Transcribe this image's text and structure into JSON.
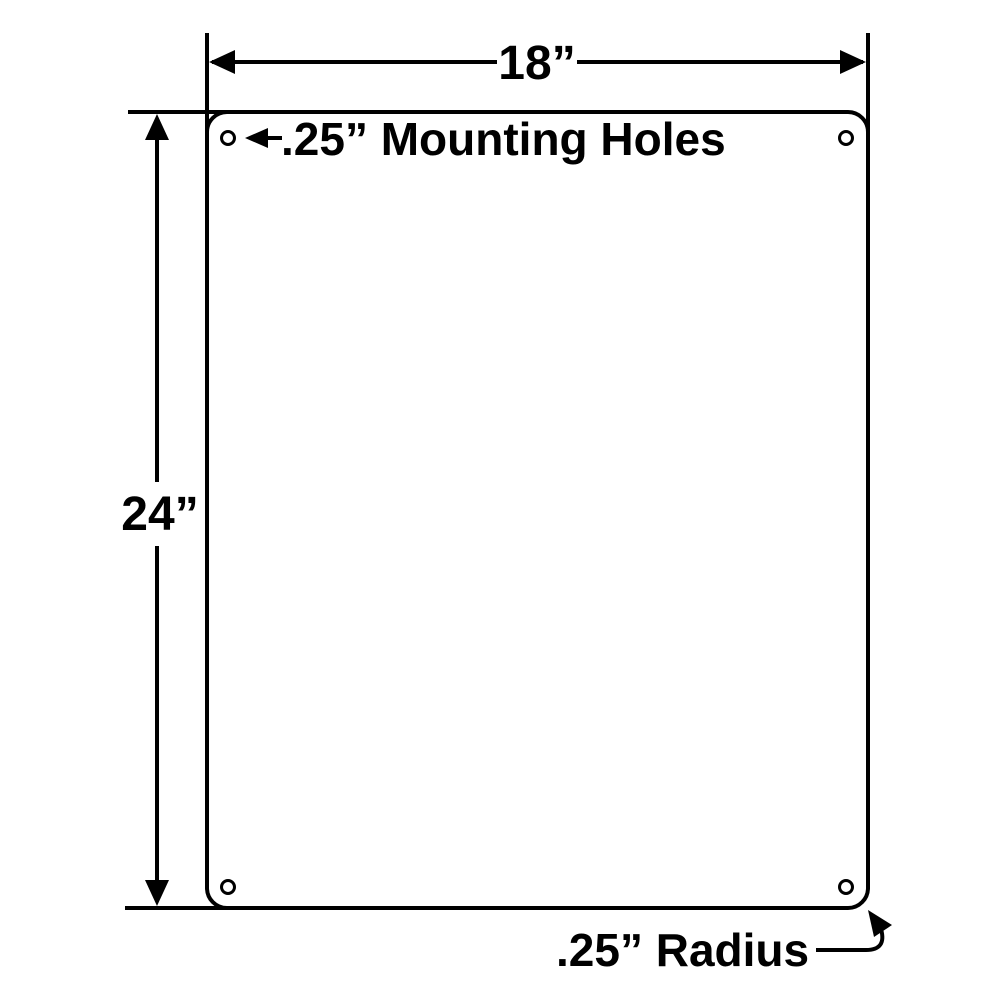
{
  "diagram": {
    "type": "technical-dimension-drawing",
    "subject": "blank rectangular panel with rounded corners and four corner mounting holes",
    "colors": {
      "line": "#000000",
      "background": "#ffffff"
    },
    "width_dimension": {
      "label": "18”"
    },
    "height_dimension": {
      "label": "24”"
    },
    "mounting_holes": {
      "label": ".25” Mounting Holes",
      "count": 4
    },
    "corner_radius": {
      "label": ".25” Radius"
    }
  }
}
